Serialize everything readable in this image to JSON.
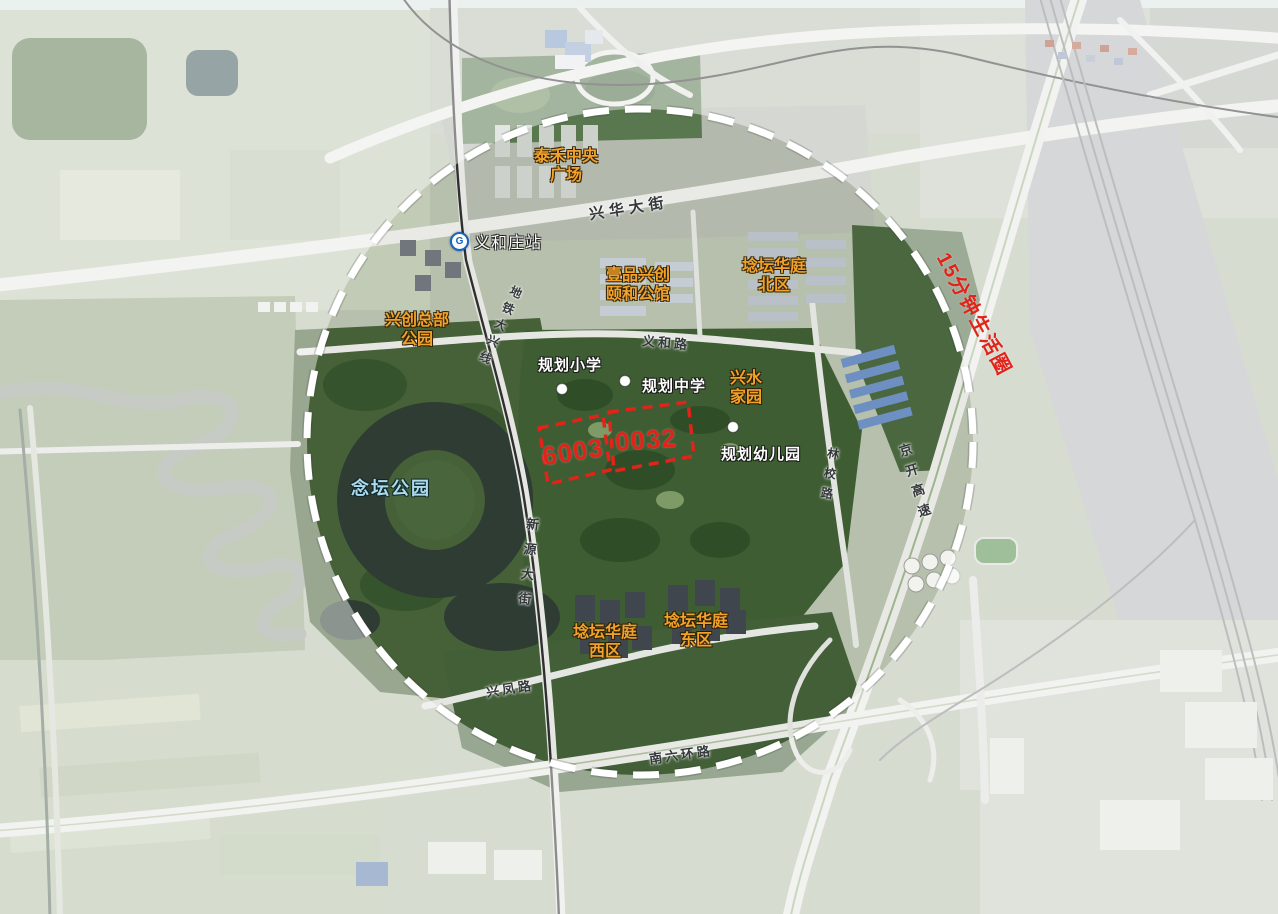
{
  "colors": {
    "place_label_orange": "#F2A22B",
    "poi_label_white": "#FFFFFF",
    "park_label_blue": "#ABDCEE",
    "highlight_red": "#E2231A",
    "road_label_dark": "#34383B",
    "boundary_white": "#FFFFFF"
  },
  "icons": {
    "metro": "G",
    "poi_dot": "white-circle"
  },
  "circle": {
    "label": "15分钟生活圈"
  },
  "parcels": {
    "west": "6003",
    "east": "0032"
  },
  "places": {
    "taihe": {
      "line1": "泰禾中央",
      "line2": "广场"
    },
    "station": "义和庄站",
    "yipin": {
      "line1": "壹品兴创",
      "line2": "颐和公馆"
    },
    "huating_north": {
      "line1": "埝坛华庭",
      "line2": "北区"
    },
    "xingchuang_hq": {
      "line1": "兴创总部",
      "line2": "公园"
    },
    "primary_school": "规划小学",
    "middle_school": "规划中学",
    "xingshui": {
      "line1": "兴水",
      "line2": "家园"
    },
    "kindergarten": "规划幼儿园",
    "niantan_park": "念坛公园",
    "huating_west": {
      "line1": "埝坛华庭",
      "line2": "西区"
    },
    "huating_east": {
      "line1": "埝坛华庭",
      "line2": "东区"
    }
  },
  "roads": {
    "xinghua_ave": "兴华大街",
    "metro_line": "地铁大兴线",
    "yihe_rd": "义和路",
    "xinyuan_st": "新源大街",
    "linxiao_rd": "林校路",
    "jingkai_expwy": "京开高速",
    "xingfeng_rd": "兴凤路",
    "south_6th_ring": "南六环路"
  }
}
